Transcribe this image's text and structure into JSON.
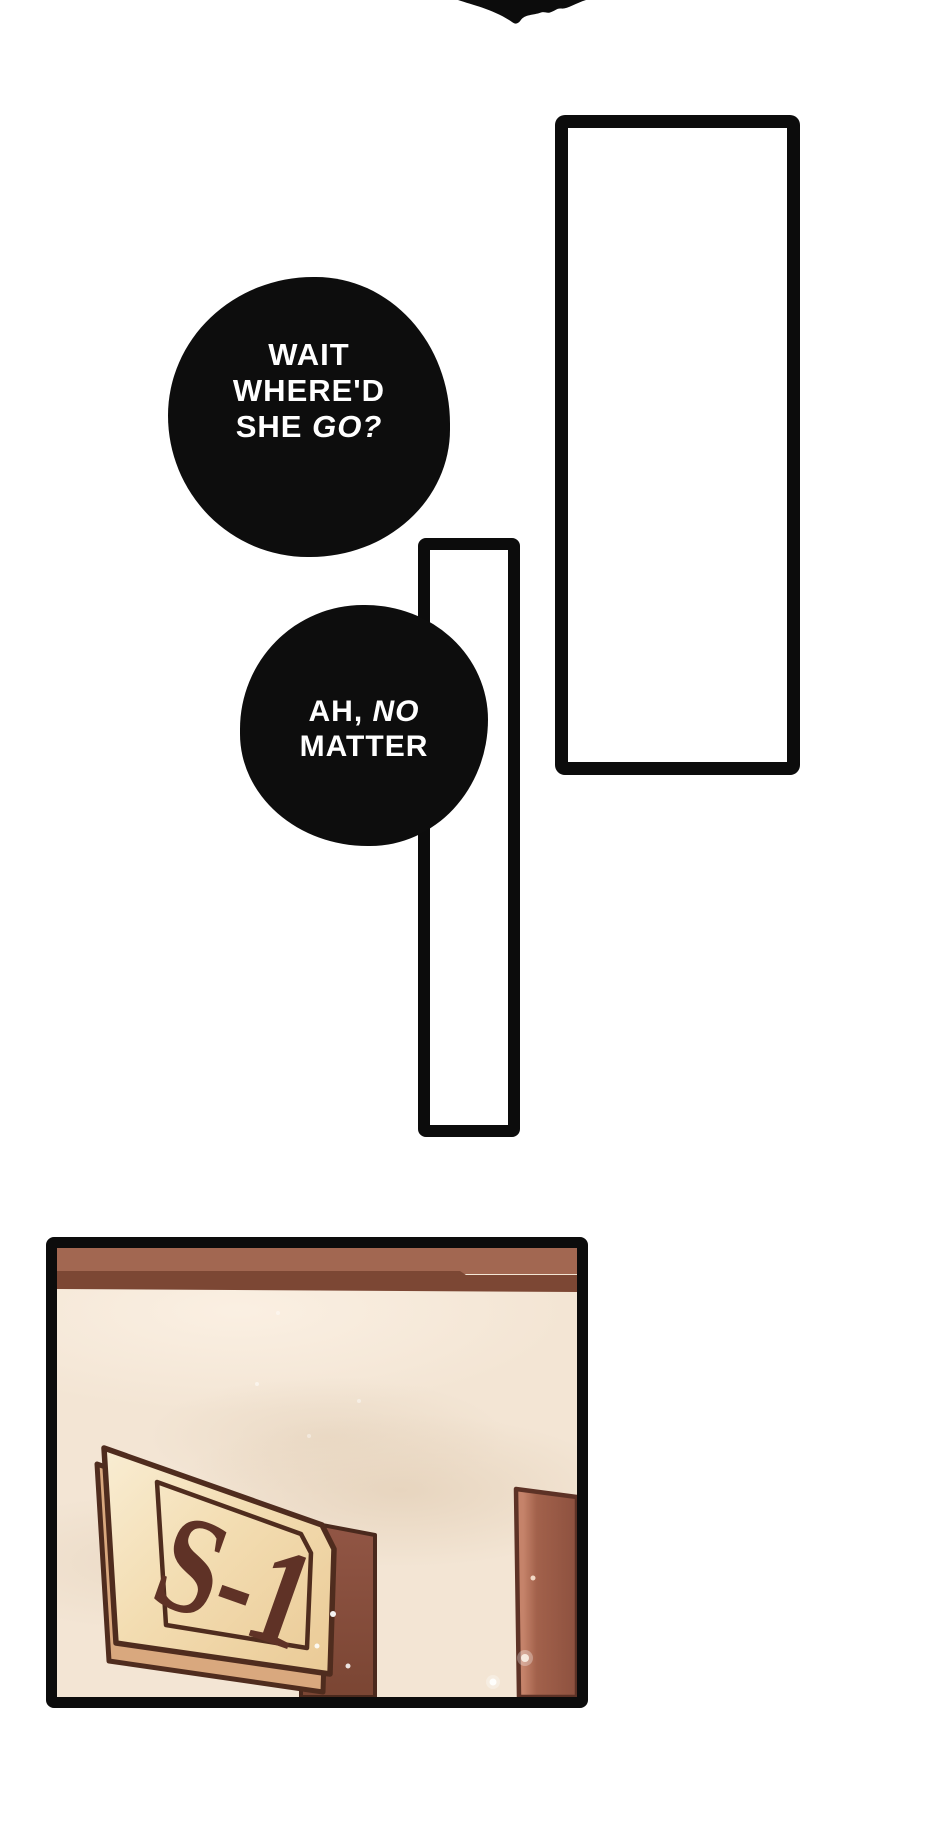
{
  "page": {
    "kind": "webtoon comic strip segment",
    "background": "#ffffff"
  },
  "bubble1": {
    "line1": "WAIT",
    "line2": "WHERE'D",
    "line3a": "SHE",
    "line3b": "GO?"
  },
  "bubble2": {
    "line1a": "AH,",
    "line1b": "NO",
    "line2": "MATTER"
  },
  "sign": {
    "text": "S-1"
  },
  "colors": {
    "ink": "#0c0c0c",
    "bubble_fill": "#0d0d0d",
    "bubble_text": "#ffffff",
    "beam": "#a26751",
    "beam_shadow": "#7c4734",
    "wall": "#f3e5d4",
    "wall_shade": "#e5d2bb",
    "plaque_face_light": "#f9edd3",
    "plaque_face_dark": "#eaca96",
    "plaque_side": "#d9a87e",
    "plaque_outline": "#4f2c1e",
    "sign_text_color": "#5f3226",
    "post": "#925645",
    "post_dark": "#7a4533",
    "board": "#8d513f",
    "board_highlight": "#c5836a",
    "board_outline": "#5d3226"
  }
}
